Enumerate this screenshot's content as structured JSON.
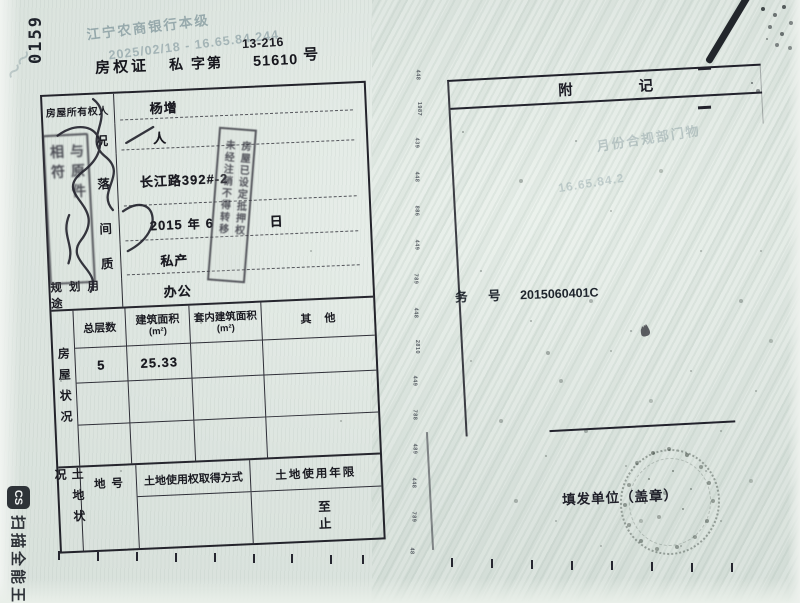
{
  "photo": {
    "corner_code": "0159",
    "page_code": "13-216",
    "watermarks": {
      "bank_line": "江宁农商银行本级",
      "date_line": "2025/02/18 - 16.65.84.244",
      "right_fragment_1": "月份合规部门物",
      "right_fragment_2": "16.65.84.2",
      "corner_squiggle": "～～"
    },
    "camscanner": {
      "icon_glyph": "CS",
      "label": "扫描全能王"
    }
  },
  "certificate": {
    "title": {
      "doc": "房权证",
      "type": "私",
      "zi": "字第",
      "number": "51610",
      "hao": "号"
    },
    "owner_rows": {
      "r1": {
        "label": "房屋所有权人",
        "value": "杨增"
      },
      "r2": {
        "label": "况",
        "value": "人"
      },
      "r3": {
        "label": "落",
        "value": "长江路392#-2"
      },
      "r4": {
        "label": "间",
        "year": "2015",
        "year_unit": "年",
        "month": "6",
        "day_unit": "日"
      },
      "r5": {
        "label": "质",
        "value": "私产"
      },
      "r6": {
        "label": "规划用途",
        "value": "办公"
      }
    },
    "building_section": {
      "side_label": "房屋状况",
      "headers": {
        "floors": "总层数",
        "area": "建筑面积",
        "area_unit": "(m²)",
        "inner_area": "套内建筑面积",
        "inner_area_unit": "(m²)",
        "other": "其他"
      },
      "row1": {
        "floors": "5",
        "area": "25.33",
        "inner_area": "",
        "other": ""
      }
    },
    "land_section": {
      "side_label": "土地状况",
      "land_no_label": "地号",
      "method_label": "土地使用权取得方式",
      "term_label": "土地使用年限",
      "term_from": "至",
      "term_to": "止"
    },
    "stamps": {
      "verify_col1": "与原件",
      "verify_col2": "相符",
      "mortgage_col1": "房屋已设定抵押权",
      "mortgage_col2": "未经注销不得转移"
    }
  },
  "notes_panel": {
    "title": "附记",
    "biz_label": "务　号",
    "biz_value": "2015060401C",
    "issuer_label": "填发单位（盖章）"
  },
  "spine_marks": [
    "448",
    "1987",
    "439",
    "448",
    "886",
    "449",
    "789",
    "448",
    "2810",
    "449",
    "788",
    "489",
    "448",
    "789",
    "48"
  ]
}
